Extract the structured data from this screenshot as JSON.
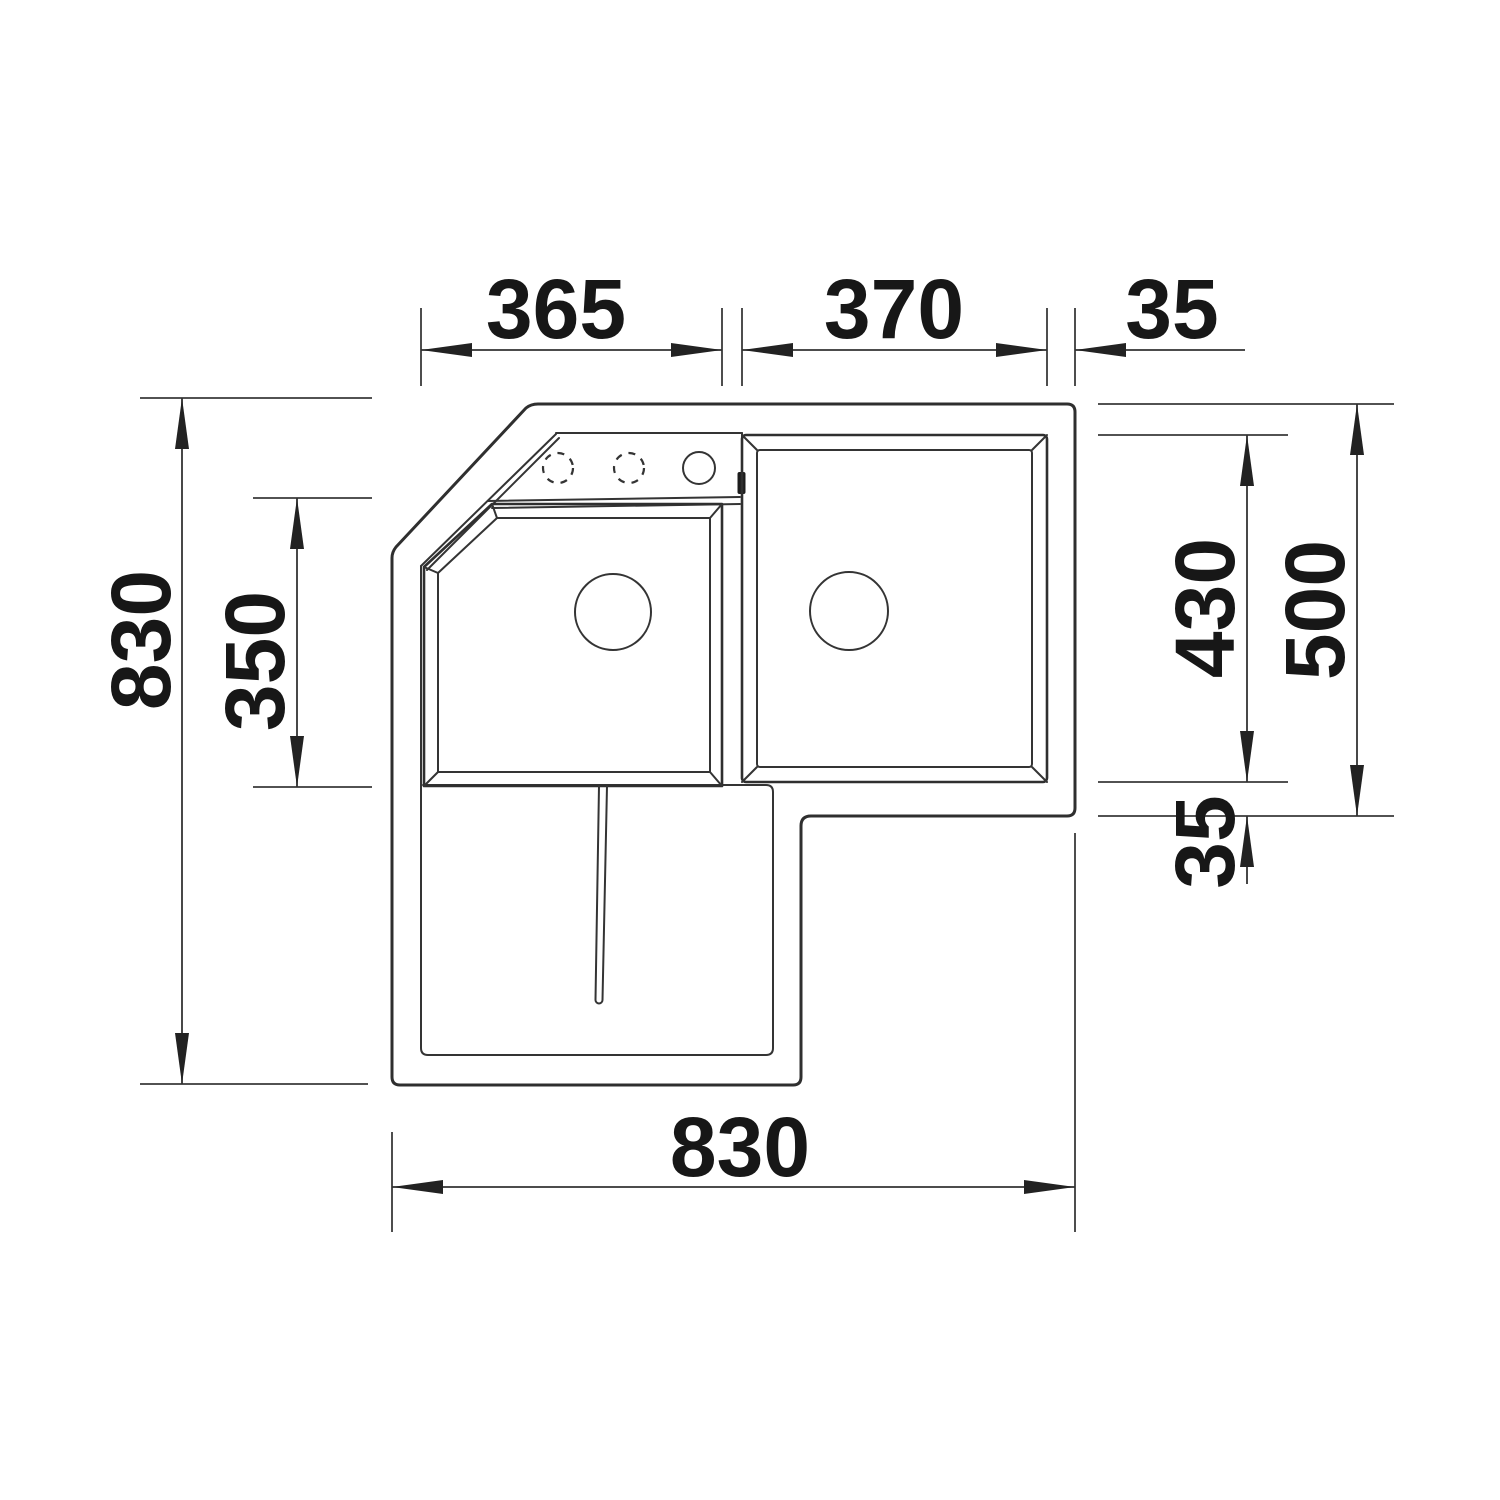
{
  "diagram": {
    "type": "technical-plan-drawing",
    "subject": "corner-sink-top-view",
    "unit": "mm",
    "dimensions": {
      "top_left_width": "365",
      "top_bowl_width": "370",
      "top_right_rim": "35",
      "left_overall_depth": "830",
      "left_bowl_depth": "350",
      "right_bowl_depth": "430",
      "right_section_depth": "500",
      "right_bottom_rim": "35",
      "bottom_overall_width": "830"
    },
    "colors": {
      "background": "#ffffff",
      "line": "#2f2f2f",
      "dimension_line": "#333333",
      "text": "#171717"
    }
  }
}
